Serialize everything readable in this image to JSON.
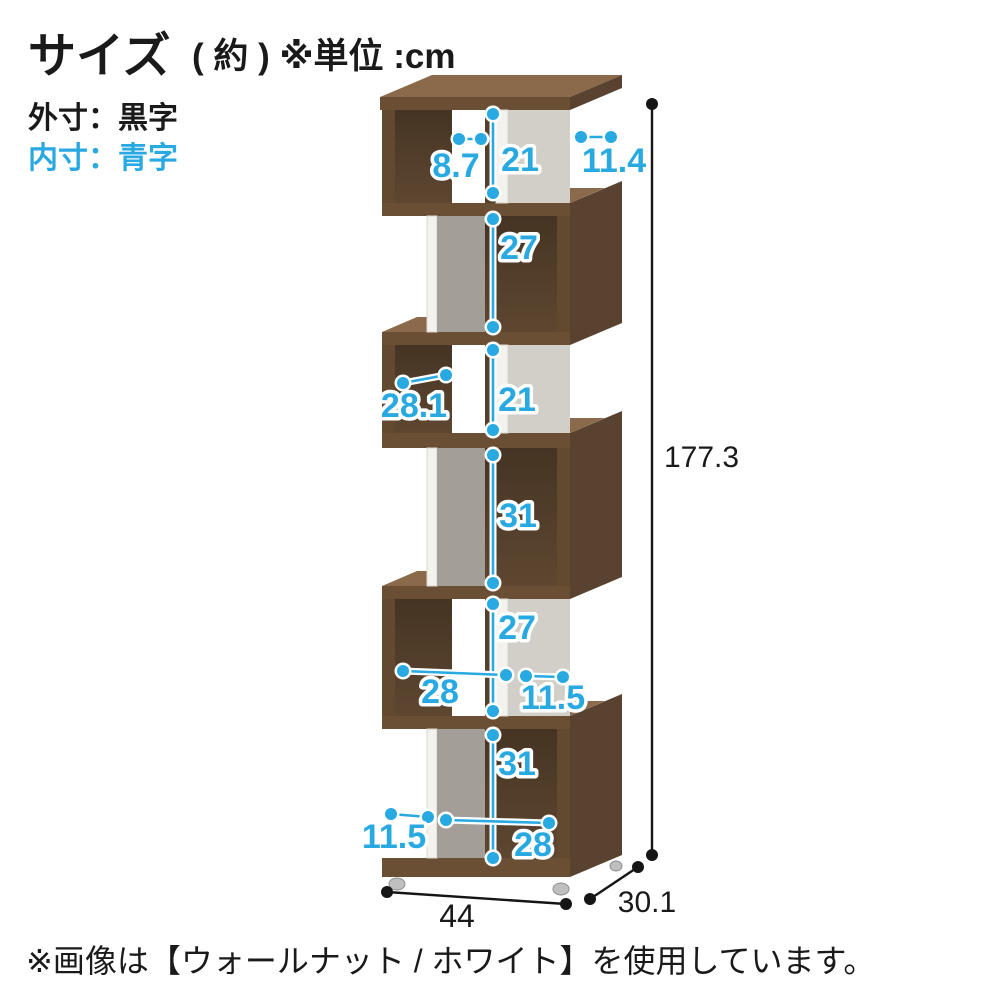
{
  "header": {
    "title": "サイズ",
    "title_note": "( 約 ) ※単位 :cm",
    "legend_outer": "外寸：黒字",
    "legend_inner": "内寸：青字"
  },
  "footer": {
    "note": "※画像は【ウォールナット / ホワイト】を使用しています。"
  },
  "colors": {
    "inner_dim_blue": "#29a9e1",
    "outer_dim_black": "#1a1a1a",
    "wood_walnut_front": "#6a4f35",
    "wood_walnut_top": "#8a6a4a",
    "panel_white": "#f4f2ec",
    "panel_gray": "#a39f98"
  },
  "dims": {
    "outer": {
      "height": "177.3",
      "width": "44",
      "depth": "30.1"
    },
    "inner": {
      "l1_height": "21",
      "l1_left_width": "8.7",
      "l1_right_depth": "11.4",
      "l2_height": "27",
      "l3_height": "21",
      "l3_width": "28.1",
      "l4_height": "31",
      "l5_height": "27",
      "l5_width": "28",
      "l5_right_depth": "11.5",
      "l6_height": "31",
      "l6_left_depth": "11.5",
      "l6_width": "28"
    }
  }
}
